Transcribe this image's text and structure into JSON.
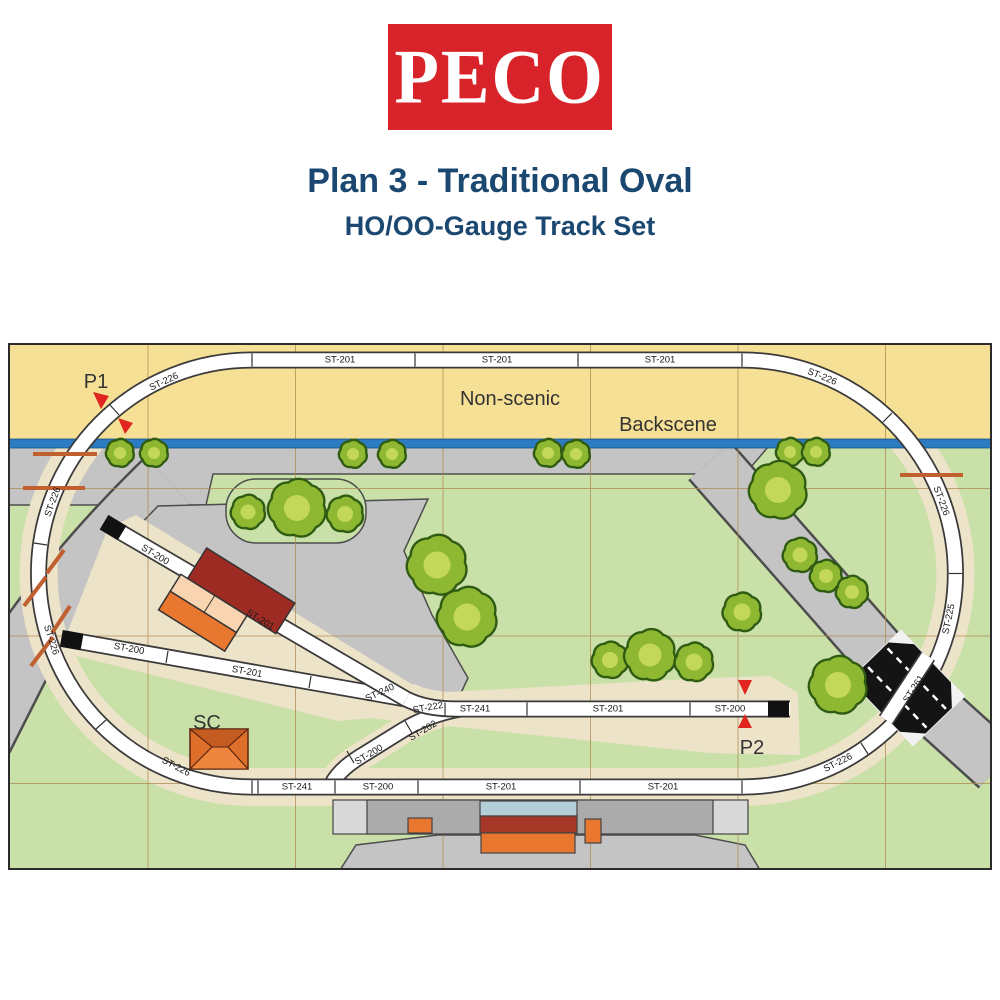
{
  "header": {
    "logo_text": "PECO",
    "title": "Plan 3 - Traditional Oval",
    "subtitle": "HO/OO-Gauge Track Set"
  },
  "colors": {
    "logo_red": "#D8232A",
    "title_navy": "#1B4870",
    "non_scenic_yellow": "#F6E096",
    "scenic_green": "#C9E0A8",
    "road_grey": "#C4C4C4",
    "ballast_beige": "#EDE3C9",
    "backscene_blue": "#2B7CC2",
    "track_white": "#FFFFFF",
    "track_edge": "#3A3A3A",
    "grid_tan": "#B08A52",
    "tree_dark": "#2F5B12",
    "tree_mid": "#8FB832",
    "tree_light": "#C9DA5E",
    "arrow_red": "#E02520",
    "crossing_bar_orange": "#C06030",
    "shed_red": "#9E2B23",
    "shed_peach": "#F8D5B0",
    "shed_orange": "#E8772F",
    "platform_grey": "#ABABAB",
    "platform_end_grey": "#D9D9D9",
    "canopy_blue": "#B5CFD8",
    "buffer_black": "#111111"
  },
  "plan": {
    "zone_labels": {
      "non_scenic": "Non-scenic",
      "backscene": "Backscene"
    },
    "point_labels": {
      "p1": "P1",
      "p2": "P2",
      "sc": "SC"
    },
    "track_labels": [
      {
        "text": "ST-201",
        "x": 332,
        "y": 17,
        "r": 0
      },
      {
        "text": "ST-201",
        "x": 489,
        "y": 17,
        "r": 0
      },
      {
        "text": "ST-201",
        "x": 652,
        "y": 17,
        "r": 0
      },
      {
        "text": "ST-226",
        "x": 814,
        "y": 34,
        "r": 22
      },
      {
        "text": "ST-226",
        "x": 933,
        "y": 158,
        "r": 70
      },
      {
        "text": "ST-225",
        "x": 941,
        "y": 276,
        "r": -78
      },
      {
        "text": "ST-226",
        "x": 830,
        "y": 420,
        "r": -27
      },
      {
        "text": "ST-226",
        "x": 156,
        "y": 39,
        "r": -25
      },
      {
        "text": "ST-226",
        "x": 45,
        "y": 159,
        "r": -70
      },
      {
        "text": "ST-226",
        "x": 43,
        "y": 297,
        "r": 72
      },
      {
        "text": "ST-226",
        "x": 168,
        "y": 424,
        "r": 28
      },
      {
        "text": "ST-241",
        "x": 289,
        "y": 444,
        "r": 0
      },
      {
        "text": "ST-200",
        "x": 370,
        "y": 444,
        "r": 0
      },
      {
        "text": "ST-201",
        "x": 493,
        "y": 444,
        "r": 0
      },
      {
        "text": "ST-201",
        "x": 655,
        "y": 444,
        "r": 0
      },
      {
        "text": "ST-240",
        "x": 372,
        "y": 350,
        "r": -25
      },
      {
        "text": "ST-222",
        "x": 420,
        "y": 365,
        "r": -10
      },
      {
        "text": "ST-241",
        "x": 467,
        "y": 366,
        "r": 0
      },
      {
        "text": "ST-201",
        "x": 600,
        "y": 366,
        "r": 0
      },
      {
        "text": "ST-200",
        "x": 722,
        "y": 366,
        "r": 0
      },
      {
        "text": "ST-202",
        "x": 415,
        "y": 388,
        "r": -31
      },
      {
        "text": "ST-200",
        "x": 361,
        "y": 412,
        "r": -31
      },
      {
        "text": "ST-200",
        "x": 147,
        "y": 212,
        "r": 31
      },
      {
        "text": "ST-201",
        "x": 252,
        "y": 277,
        "r": 31
      },
      {
        "text": "ST-200",
        "x": 121,
        "y": 306,
        "r": 10
      },
      {
        "text": "ST-201",
        "x": 239,
        "y": 329,
        "r": 10
      },
      {
        "text": "ST-261",
        "x": 906,
        "y": 346,
        "r": -57
      }
    ],
    "rail_joints": [
      [
        407,
        10.5,
        407,
        23.5
      ],
      [
        570,
        10.5,
        570,
        23.5
      ],
      [
        244,
        10.5,
        244,
        23.5
      ],
      [
        734,
        10.5,
        734,
        23.5
      ],
      [
        250,
        437.5,
        250,
        450.5
      ],
      [
        327,
        437.5,
        327,
        450.5
      ],
      [
        410,
        437.5,
        410,
        450.5
      ],
      [
        572,
        437.5,
        572,
        450.5
      ],
      [
        244,
        437.5,
        244,
        450.5
      ],
      [
        734,
        437.5,
        734,
        450.5
      ],
      [
        437,
        359.5,
        437,
        372.5
      ],
      [
        519,
        359.5,
        519,
        372.5
      ],
      [
        682,
        359.5,
        682,
        372.5
      ],
      [
        875,
        79,
        884,
        70
      ],
      [
        941,
        230.5,
        954,
        230.5
      ],
      [
        853,
        400,
        860,
        411
      ],
      [
        111,
        72,
        102,
        62
      ],
      [
        39,
        202,
        26,
        200
      ],
      [
        98,
        377,
        88,
        386
      ],
      [
        397,
        378,
        404,
        390
      ],
      [
        339,
        408,
        346,
        420
      ],
      [
        200,
        233,
        194,
        245
      ],
      [
        160,
        308,
        158,
        320
      ],
      [
        303,
        333,
        301,
        345
      ]
    ],
    "trees": [
      {
        "x": 112,
        "y": 110,
        "r": 12
      },
      {
        "x": 146,
        "y": 110,
        "r": 12
      },
      {
        "x": 345,
        "y": 111,
        "r": 12
      },
      {
        "x": 384,
        "y": 111,
        "r": 12
      },
      {
        "x": 540,
        "y": 110,
        "r": 12
      },
      {
        "x": 568,
        "y": 111,
        "r": 12
      },
      {
        "x": 782,
        "y": 109,
        "r": 12
      },
      {
        "x": 808,
        "y": 109,
        "r": 12
      },
      {
        "x": 240,
        "y": 169,
        "r": 15
      },
      {
        "x": 289,
        "y": 165,
        "r": 26
      },
      {
        "x": 337,
        "y": 171,
        "r": 16
      },
      {
        "x": 429,
        "y": 222,
        "r": 27
      },
      {
        "x": 459,
        "y": 274,
        "r": 27
      },
      {
        "x": 602,
        "y": 317,
        "r": 16
      },
      {
        "x": 642,
        "y": 312,
        "r": 23
      },
      {
        "x": 686,
        "y": 319,
        "r": 17
      },
      {
        "x": 734,
        "y": 269,
        "r": 17
      },
      {
        "x": 770,
        "y": 147,
        "r": 26
      },
      {
        "x": 792,
        "y": 212,
        "r": 15
      },
      {
        "x": 818,
        "y": 233,
        "r": 14
      },
      {
        "x": 844,
        "y": 249,
        "r": 14
      },
      {
        "x": 830,
        "y": 342,
        "r": 26
      }
    ]
  }
}
